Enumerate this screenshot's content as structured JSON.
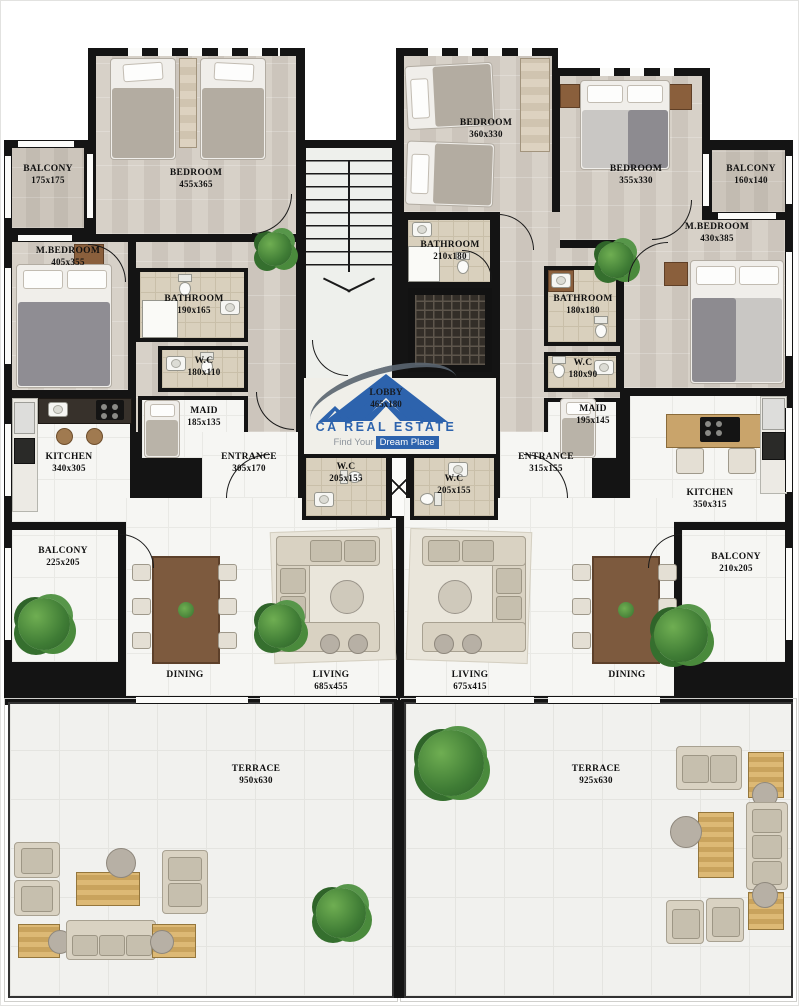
{
  "brand": {
    "name": "CA REAL ESTATE",
    "tagline_prefix": "Find Your",
    "tagline_highlight": "Dream Place",
    "blue": "#2d63ad"
  },
  "lobby": {
    "label": "LOBBY",
    "dims": "465x180"
  },
  "left": {
    "balcony_top": {
      "label": "BALCONY",
      "dims": "175x175"
    },
    "bedroom": {
      "label": "BEDROOM",
      "dims": "455x365"
    },
    "m_bedroom": {
      "label": "M.BEDROOM",
      "dims": "405x355"
    },
    "bathroom": {
      "label": "BATHROOM",
      "dims": "190x165"
    },
    "wc": {
      "label": "W.C",
      "dims": "180x110"
    },
    "maid": {
      "label": "MAID",
      "dims": "185x135"
    },
    "entrance": {
      "label": "ENTRANCE",
      "dims": "305x170"
    },
    "kitchen": {
      "label": "KITCHEN",
      "dims": "340x305"
    },
    "balcony_mid": {
      "label": "BALCONY",
      "dims": "225x205"
    },
    "wc_front": {
      "label": "W.C",
      "dims": "205x155"
    },
    "dining": {
      "label": "DINING",
      "dims": ""
    },
    "living": {
      "label": "LIVING",
      "dims": "685x455"
    },
    "terrace": {
      "label": "TERRACE",
      "dims": "950x630"
    }
  },
  "right": {
    "bedroom_a": {
      "label": "BEDROOM",
      "dims": "360x330"
    },
    "bedroom_b": {
      "label": "BEDROOM",
      "dims": "355x330"
    },
    "balcony_top": {
      "label": "BALCONY",
      "dims": "160x140"
    },
    "m_bedroom": {
      "label": "M.BEDROOM",
      "dims": "430x385"
    },
    "bathroom_a": {
      "label": "BATHROOM",
      "dims": "210x180"
    },
    "bathroom_b": {
      "label": "BATHROOM",
      "dims": "180x180"
    },
    "wc": {
      "label": "W.C",
      "dims": "180x90"
    },
    "maid": {
      "label": "MAID",
      "dims": "195x145"
    },
    "entrance": {
      "label": "ENTRANCE",
      "dims": "315x155"
    },
    "kitchen": {
      "label": "KITCHEN",
      "dims": "350x315"
    },
    "balcony_mid": {
      "label": "BALCONY",
      "dims": "210x205"
    },
    "wc_front": {
      "label": "W.C",
      "dims": "205x155"
    },
    "living": {
      "label": "LIVING",
      "dims": "675x415"
    },
    "dining": {
      "label": "DINING",
      "dims": ""
    },
    "terrace": {
      "label": "TERRACE",
      "dims": "925x630"
    }
  },
  "colors": {
    "wall": "#141414",
    "brand_blue": "#2d63ad"
  }
}
